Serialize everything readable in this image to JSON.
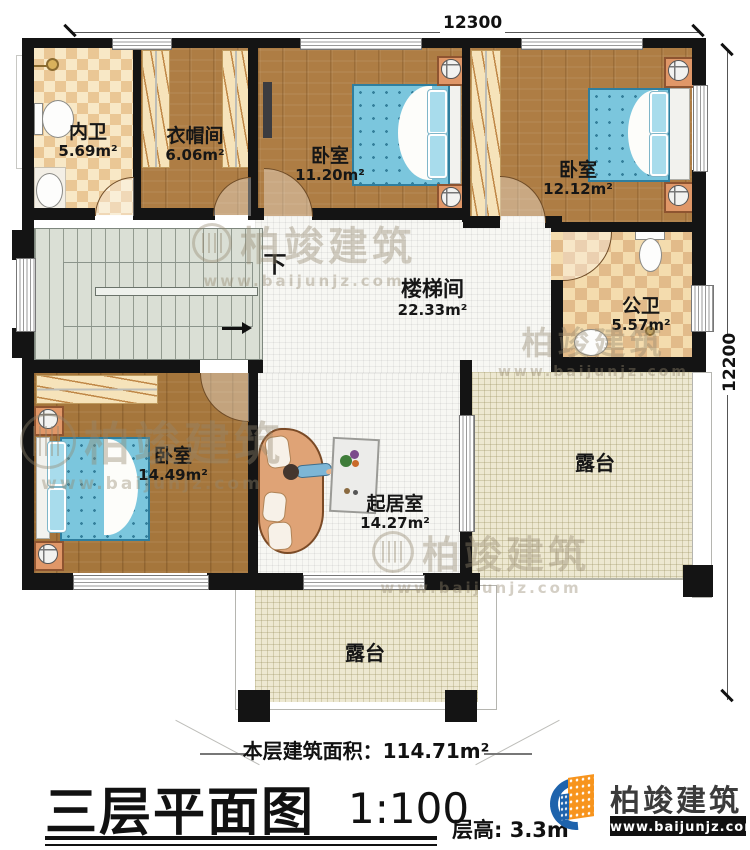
{
  "dimensions": {
    "top": "12300",
    "right": "12200"
  },
  "rooms": [
    {
      "name": "内卫",
      "area": "5.69m²"
    },
    {
      "name": "衣帽间",
      "area": "6.06m²"
    },
    {
      "name": "卧室",
      "area": "11.20m²"
    },
    {
      "name": "卧室",
      "area": "12.12m²"
    },
    {
      "name": "楼梯间",
      "area": "22.33m²"
    },
    {
      "name": "公卫",
      "area": "5.57m²"
    },
    {
      "name": "卧室",
      "area": "14.49m²"
    },
    {
      "name": "起居室",
      "area": "14.27m²"
    },
    {
      "name": "露台"
    },
    {
      "name": "露台"
    }
  ],
  "stairs": {
    "down_label": "下"
  },
  "footer": {
    "area_label": "本层建筑面积：",
    "area_value": "114.71m²",
    "title": "三层平面图",
    "scale": "1:100",
    "floor_height": "层高: 3.3m"
  },
  "brand": {
    "name": "柏竣建筑",
    "url": "www.baijunjz.com"
  },
  "watermark": {
    "name": "柏竣建筑",
    "url": "www.baijunjz.com"
  },
  "colors": {
    "wall": "#141414",
    "wood": "#AE7D44",
    "tile_white": "#F7F7F3",
    "terrace": "#EDE8D1",
    "bath_checker": "#EAC795",
    "bed_blue": "#7BC6DD",
    "logo_blue": "#1E63AC",
    "logo_orange": "#F7941D"
  }
}
